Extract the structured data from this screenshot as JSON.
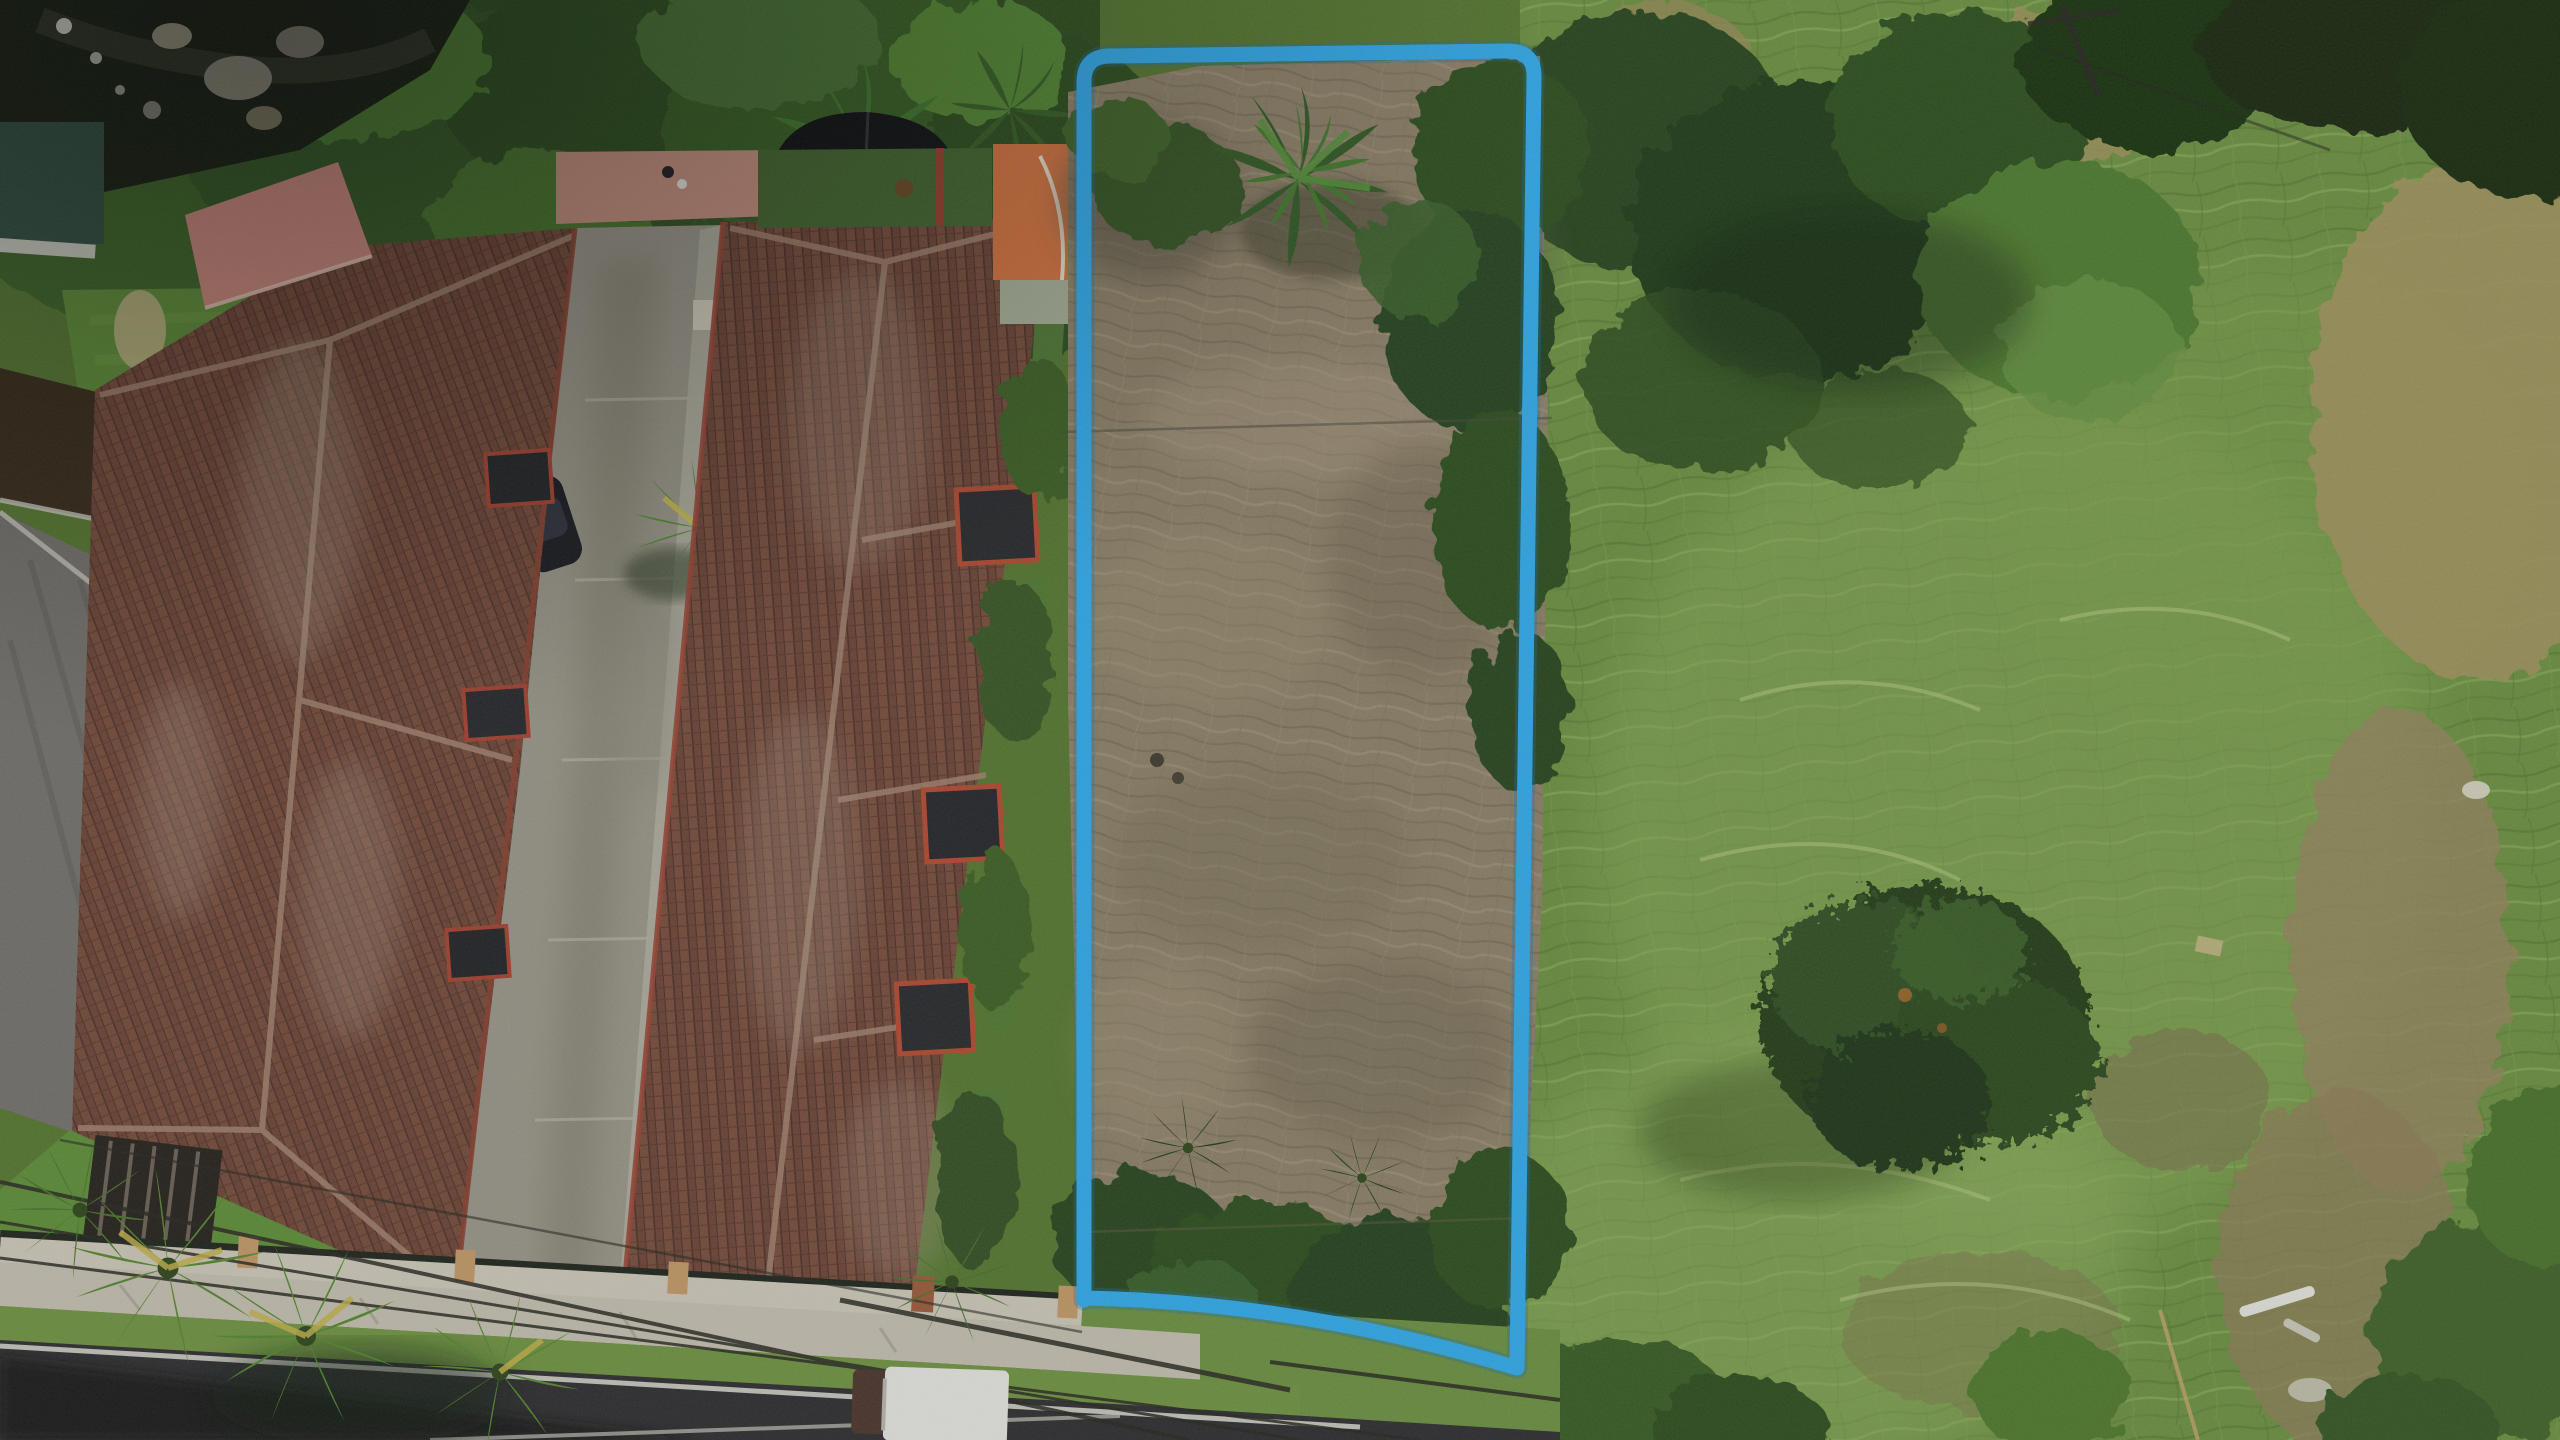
{
  "scene": {
    "type": "aerial-drone-photograph",
    "subject": "vacant land parcel highlighted with a blue boundary outline, between a tiled-roof townhouse complex (left) and an open green field (right)"
  },
  "annotation": {
    "boundary_color": "#2fadf1",
    "boundary_halo_color": "#1673b8",
    "boundary_stroke_px": 15,
    "boundary_corners": {
      "top_left": [
        1084,
        56
      ],
      "top_right": [
        1534,
        51
      ],
      "bottom_right": [
        1517,
        1368
      ],
      "bottom_left": [
        1085,
        1298
      ]
    }
  },
  "palette": {
    "base_green": "#55782f",
    "field_green": "#6b9140",
    "field_green_light": "#8db05c",
    "field_straw": "#a3955e",
    "tree_dark": "#27451a",
    "bush_green": "#3c6426",
    "bush_bright": "#5d8f38",
    "dry_grass": "#8d8168",
    "dry_grass_dark": "#6e6450",
    "dry_grass_light": "#a3947a",
    "roof_tile": "#6d4335",
    "roof_tile_dark": "#4e2f26",
    "roof_ridge": "#a3836f",
    "salmon_roof": "#cf8a7d",
    "gray_roof": "#73716c",
    "concrete": "#9a978a",
    "sidewalk": "#c6c1b2",
    "asphalt": "#2c2c2f",
    "asphalt_shadow": "#131315",
    "lawn_green": "#5d8f37",
    "tank_black": "#0b0d10",
    "orange_court": "#d8743e",
    "green_court": "#41662e",
    "pink_path": "#c9917f",
    "stream_dark": "#141c10",
    "rock_gray": "#8d8a79",
    "truck_white": "#e9e9e4",
    "power_line": "#26261f",
    "palm_green": "#55882e",
    "palm_accent": "#c4b44a"
  }
}
